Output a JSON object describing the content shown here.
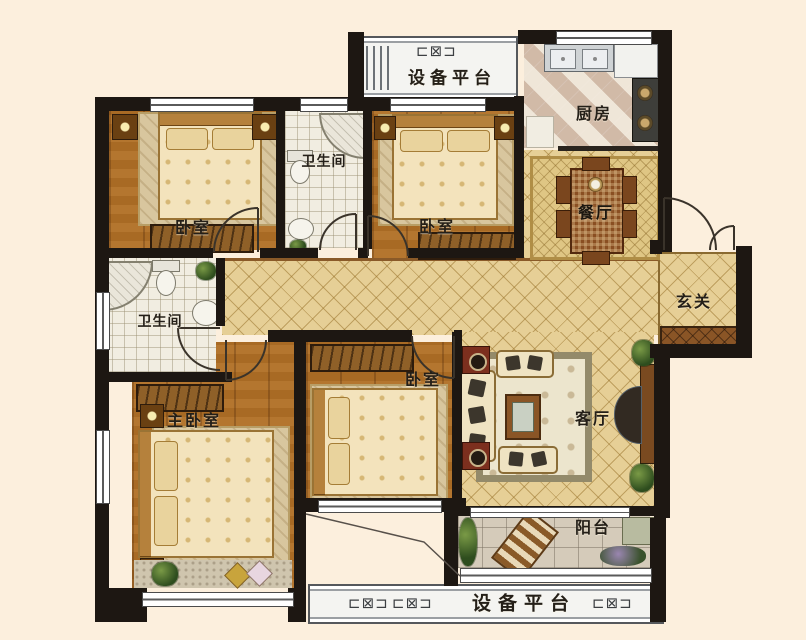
{
  "plan": {
    "background_color": "#fcefdd",
    "wall_color": "#1d1712",
    "gold_tile_color": "#e6cf96",
    "wood_floor_color": "#b1722c"
  },
  "rooms": {
    "platform_top": {
      "label": "设备平台"
    },
    "kitchen": {
      "label": "厨房"
    },
    "bedroom_top_left": {
      "label": "卧室"
    },
    "bathroom_top": {
      "label": "卫生间"
    },
    "bedroom_top_middle": {
      "label": "卧室"
    },
    "dining_room": {
      "label": "餐厅"
    },
    "entry": {
      "label": "玄关"
    },
    "bathroom_left": {
      "label": "卫生间"
    },
    "master_bedroom": {
      "label": "主卧室"
    },
    "bedroom_bottom_middle": {
      "label": "卧室"
    },
    "living_room": {
      "label": "客厅"
    },
    "balcony": {
      "label": "阳台"
    },
    "platform_bottom": {
      "label": "设备平台"
    }
  },
  "icons": {
    "ac_unit": "⊏⊠⊐"
  }
}
